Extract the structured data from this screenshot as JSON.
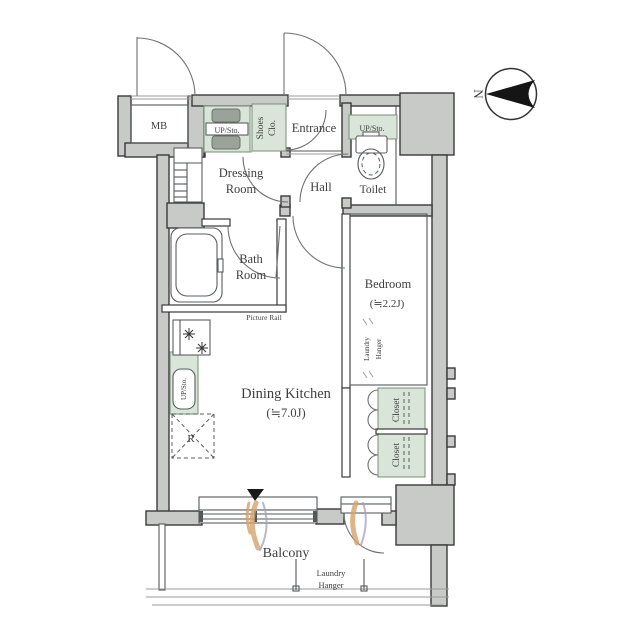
{
  "plan": {
    "rooms": {
      "mb": "MB",
      "entrance": "Entrance",
      "shoes_closet": {
        "line1": "Shoes",
        "line2": "Clo."
      },
      "dressing_room": {
        "line1": "Dressing",
        "line2": "Room"
      },
      "hall": "Hall",
      "toilet": "Toilet",
      "bath_room": {
        "line1": "Bath",
        "line2": "Room"
      },
      "bedroom": {
        "name": "Bedroom",
        "size": "(≒2.2J)"
      },
      "dining_kitchen": {
        "name": "Dining Kitchen",
        "size": "(≒7.0J)"
      },
      "balcony": "Balcony"
    },
    "fixtures": {
      "up_sto_dressing": "UP/Sto.",
      "up_sto_toilet": "UP/Sto.",
      "up_sto_kitchen": "UP/Sto.",
      "closet_upper": "Closet",
      "closet_lower": "Closet",
      "refrigerator": "R",
      "picture_rail": "Picture Rail",
      "laundry_hanger_bedroom": {
        "line1": "Laundry",
        "line2": "Hanger"
      },
      "laundry_hanger_balcony": {
        "line1": "Laundry",
        "line2": "Hanger"
      }
    },
    "compass": {
      "north": "N"
    }
  },
  "colors": {
    "wall_fill": "#c8cac8",
    "wall_stroke": "#3a3a3a",
    "storage_green": "#d9e5d8",
    "storage_green_stroke": "#81977f",
    "line": "#55585a",
    "text": "#3f3f3f",
    "curtain_tan": "#d5a368",
    "curtain_purple": "#a49cc0",
    "entry_marker": "#1a1a1a"
  }
}
